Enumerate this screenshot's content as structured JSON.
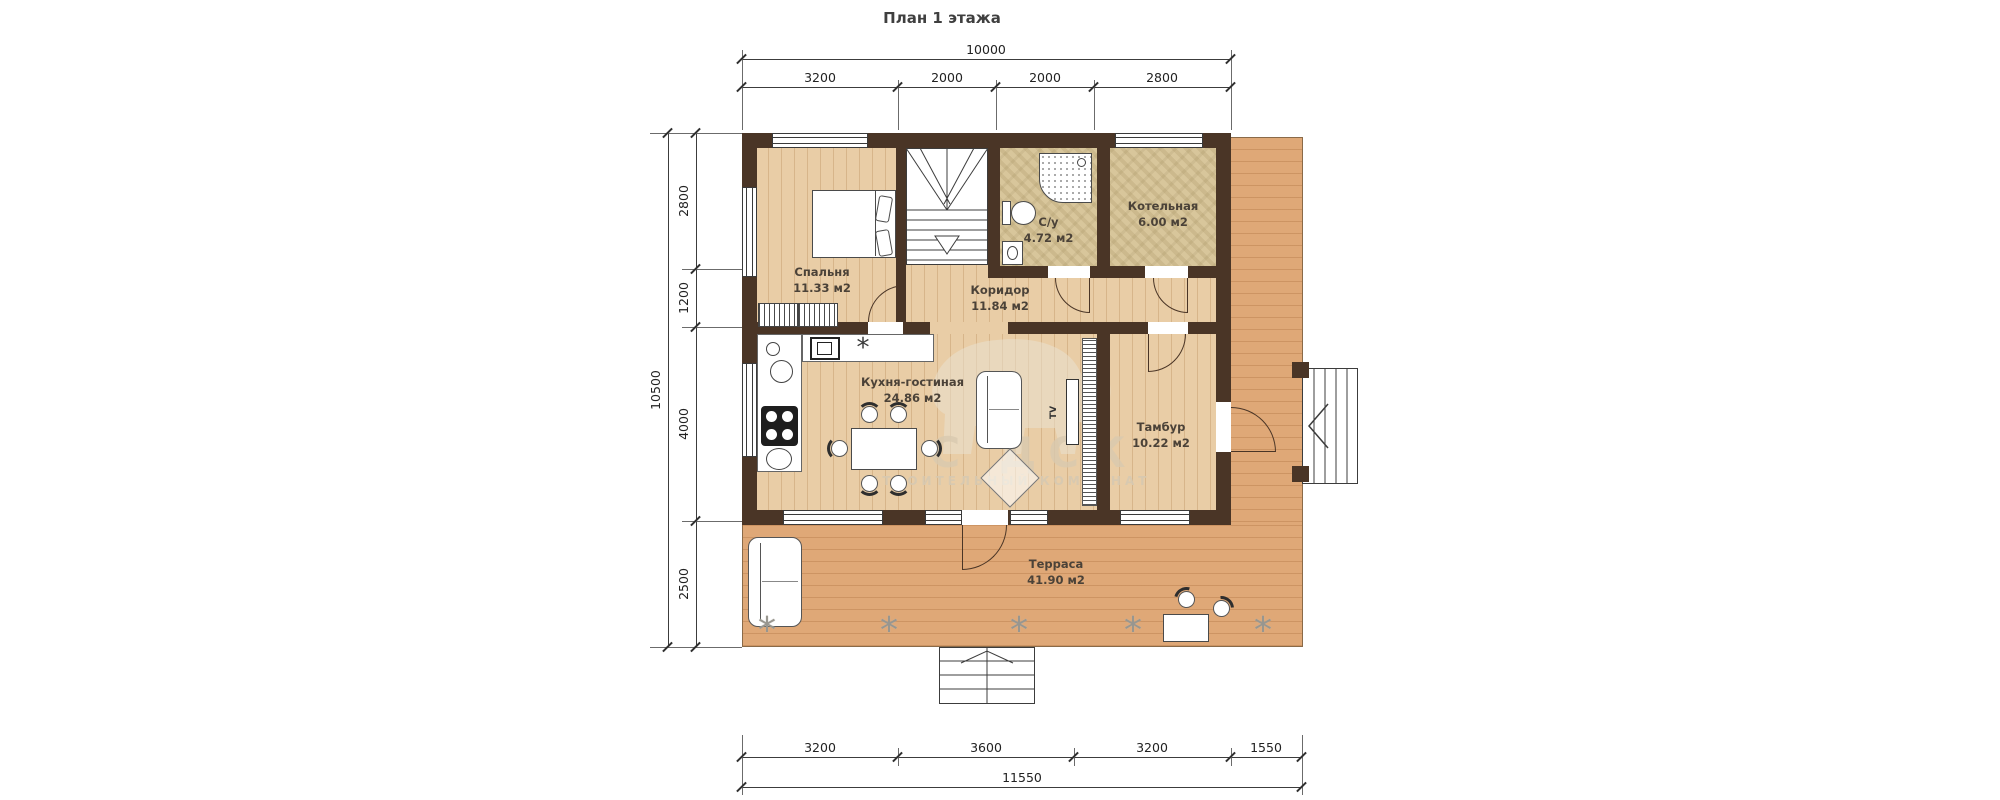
{
  "title": "План 1 этажа",
  "dimensions": {
    "top": {
      "total": "10000",
      "segments": [
        "3200",
        "2000",
        "2000",
        "2800"
      ]
    },
    "left": {
      "total": "10500",
      "segments": [
        "2800",
        "1200",
        "4000",
        "2500"
      ]
    },
    "bottom": {
      "total": "11550",
      "segments": [
        "3200",
        "3600",
        "3200",
        "1550"
      ]
    }
  },
  "rooms": [
    {
      "name": "Спальня",
      "area": "11.33 м2"
    },
    {
      "name": "С/у",
      "area": "4.72 м2"
    },
    {
      "name": "Котельная",
      "area": "6.00 м2"
    },
    {
      "name": "Коридор",
      "area": "11.84 м2"
    },
    {
      "name": "Кухня-гостиная",
      "area": "24.86 м2"
    },
    {
      "name": "Тамбур",
      "area": "10.22 м2"
    },
    {
      "name": "Терраса",
      "area": "41.90 м2"
    }
  ],
  "labels": {
    "tv": "TV"
  },
  "icons": {
    "plant": "*",
    "cooktop_star": "*"
  },
  "watermark": {
    "line1": "ЛС ДСК",
    "line2": "СТРОИТЕЛЬНЫЙ КОМБИНАТ"
  },
  "colors": {
    "wall": "#4a3526",
    "floor": "#e9cda6",
    "deck": "#dfa877",
    "tile": "#d8c69b",
    "dim_line": "#3c3c3c",
    "room_label": "#4b4238",
    "watermark": "#d8c9af"
  }
}
